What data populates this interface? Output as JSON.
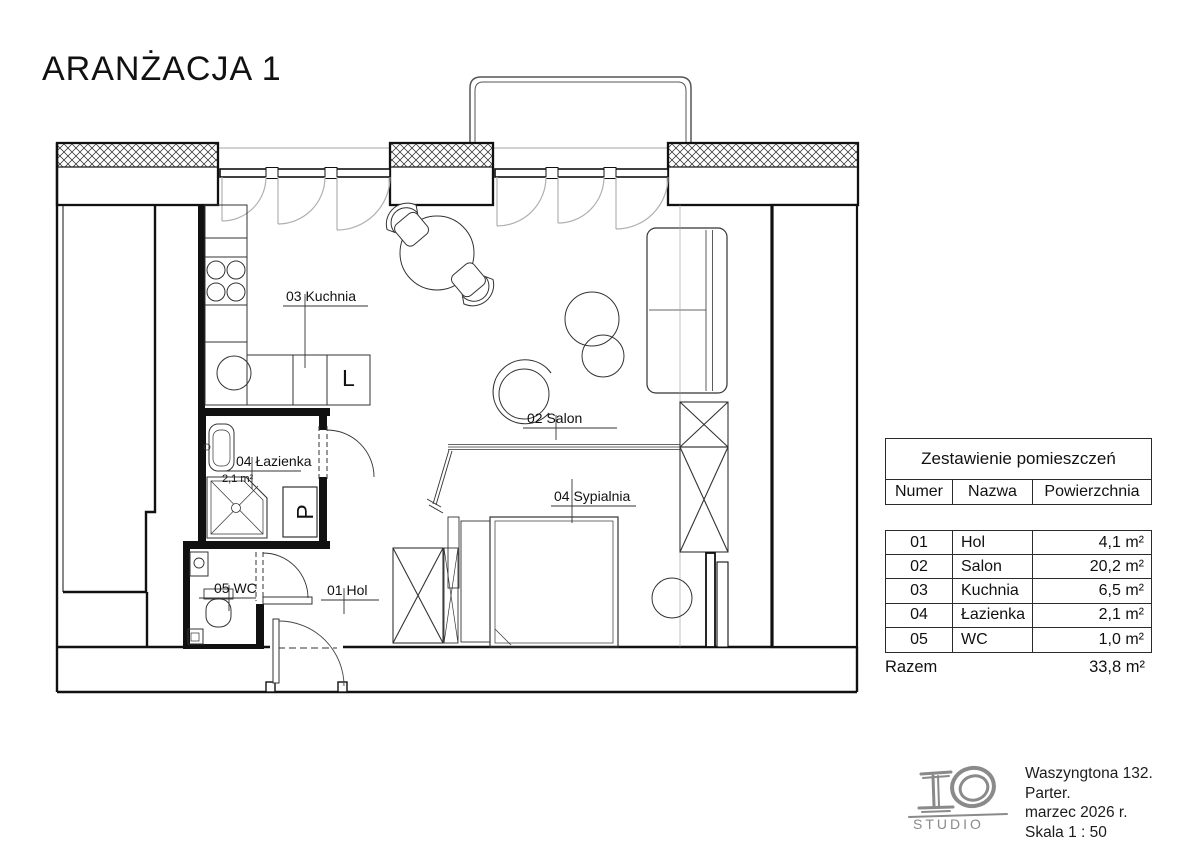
{
  "title": "ARANŻACJA 1",
  "plan": {
    "labels": {
      "kuchnia": "03 Kuchnia",
      "salon": "02 Salon",
      "sypialnia": "04 Sypialnia",
      "lazienka": "04 Łazienka",
      "lazienka_area": "2,1 m²",
      "wc": "05 WC",
      "hol": "01 Hol",
      "fridge": "L",
      "washer": "P"
    }
  },
  "summary_table": {
    "title": "Zestawienie pomieszczeń",
    "columns": [
      "Numer",
      "Nazwa",
      "Powierzchnia"
    ],
    "rows": [
      [
        "01",
        "Hol",
        "4,1 m²"
      ],
      [
        "02",
        "Salon",
        "20,2 m²"
      ],
      [
        "03",
        "Kuchnia",
        "6,5 m²"
      ],
      [
        "04",
        "Łazienka",
        "2,1 m²"
      ],
      [
        "05",
        "WC",
        "1,0 m²"
      ]
    ],
    "total_label": "Razem",
    "total_value": "33,8 m²"
  },
  "footer": {
    "logo_text": "STUDIO",
    "lines": [
      "Waszyngtona 132.",
      "Parter.",
      "marzec 2026 r.",
      "Skala  1 : 50"
    ]
  }
}
